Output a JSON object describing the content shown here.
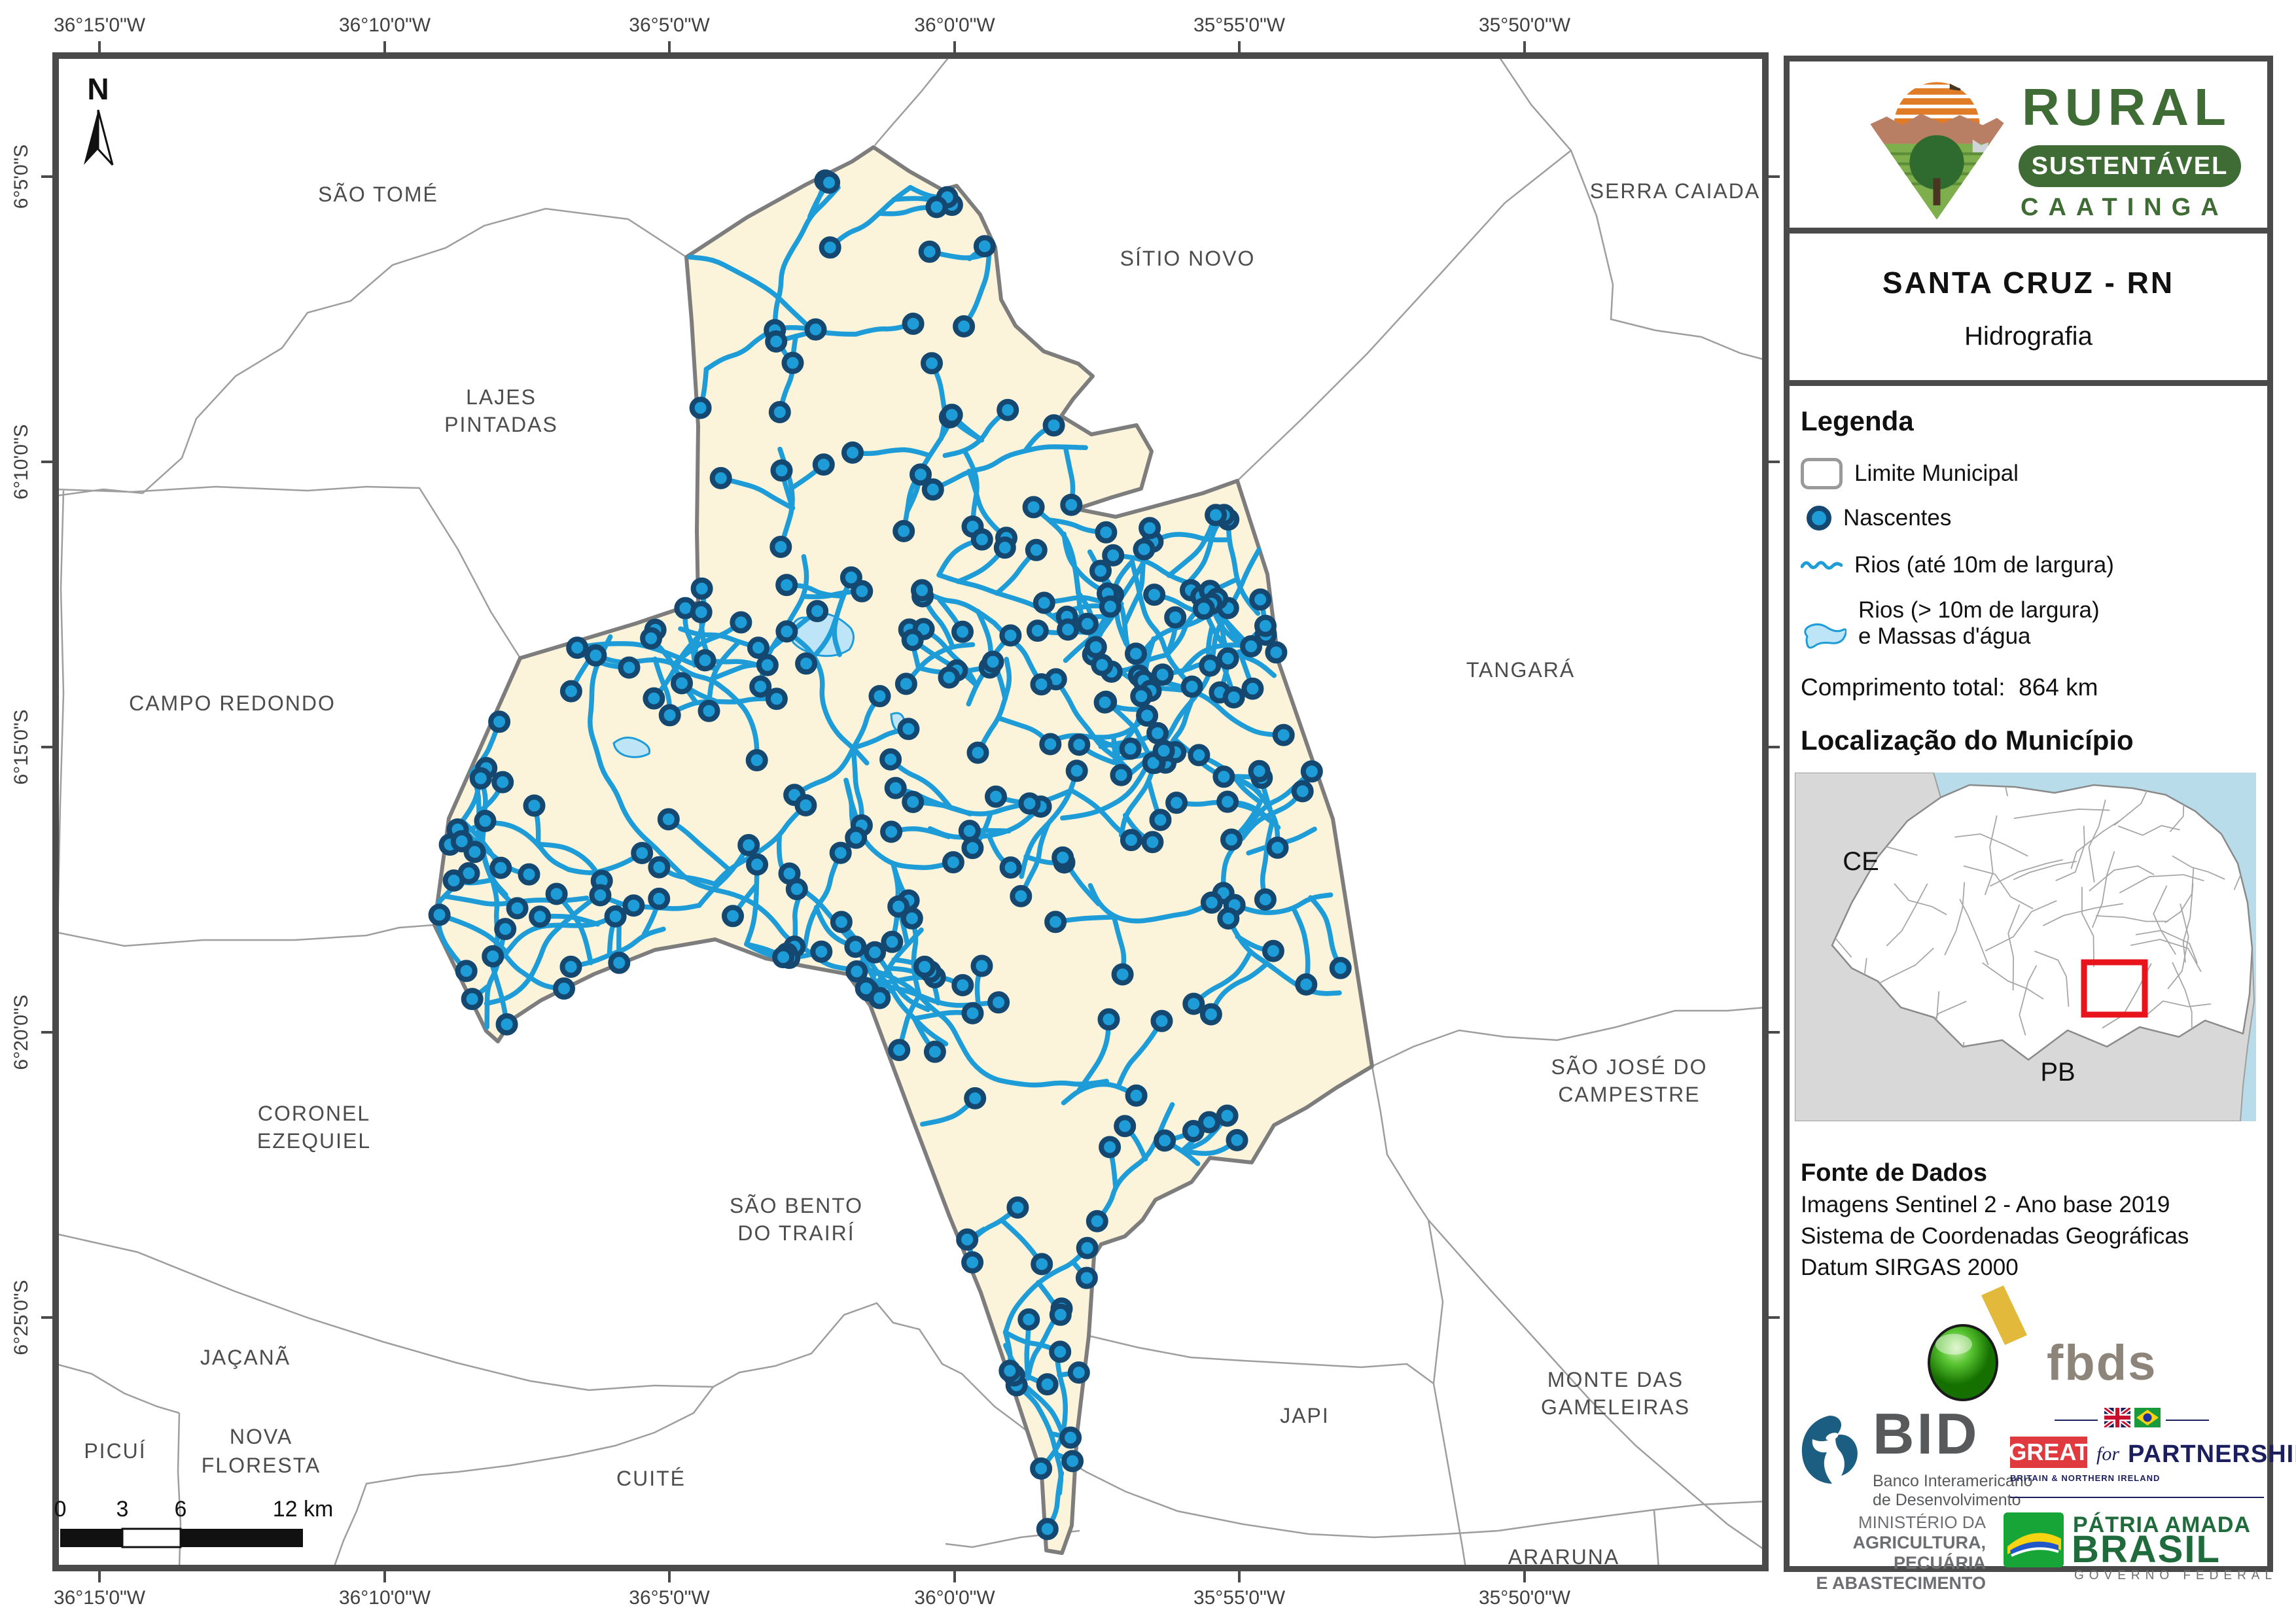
{
  "logo": {
    "line1": "RURAL",
    "line2": "SUSTENTÁVEL",
    "line3": "CAATINGA"
  },
  "title_block": {
    "municipality": "SANTA CRUZ - RN",
    "map_title": "Hidrografia"
  },
  "legend": {
    "header": "Legenda",
    "items": [
      {
        "key": "limite-municipal",
        "label": "Limite Municipal"
      },
      {
        "key": "nascentes",
        "label": "Nascentes"
      },
      {
        "key": "rios-ate-10m",
        "label": "Rios (até 10m de largura)"
      },
      {
        "key": "rios-maior-10m",
        "label": "Rios (> 10m de largura)",
        "label2": "e Massas d'água"
      }
    ],
    "total_label": "Comprimento total:",
    "total_value": "864 km"
  },
  "location": {
    "header": "Localização do Município",
    "ce": "CE",
    "pb": "PB"
  },
  "source": {
    "header": "Fonte de Dados",
    "lines": [
      "Imagens Sentinel 2 - Ano base 2019",
      "Sistema de Coordenadas Geográficas",
      "Datum SIRGAS 2000"
    ]
  },
  "partners": {
    "fbds": "fbds",
    "bid_acronym": "BID",
    "bid_name1": "Banco Interamericano",
    "bid_name2": "de Desenvolvimento",
    "great": "GREAT",
    "great_for": "for",
    "great_partnership": "PARTNERSHIP",
    "great_sub": "BRITAIN & NORTHERN IRELAND",
    "ministry": [
      "MINISTÉRIO DA",
      "AGRICULTURA, PECUÁRIA",
      "E ABASTECIMENTO"
    ],
    "patria1": "PÁTRIA AMADA",
    "patria2": "BRASIL",
    "patria3": "GOVERNO FEDERAL"
  },
  "map": {
    "north_label": "N",
    "longitudes": [
      "36°15'0\"W",
      "36°10'0\"W",
      "36°5'0\"W",
      "36°0'0\"W",
      "35°55'0\"W",
      "35°50'0\"W"
    ],
    "latitudes": [
      "6°5'0\"S",
      "6°10'0\"S",
      "6°15'0\"S",
      "6°20'0\"S",
      "6°25'0\"S"
    ],
    "neighbors": [
      "SÃO TOMÉ",
      "SÍTIO NOVO",
      "SERRA CAIADA",
      "LAJES\nPINTADAS",
      "TANGARÁ",
      "CAMPO REDONDO",
      "SÃO JOSÉ DO\nCAMPESTRE",
      "CORONEL\nEZEQUIEL",
      "SÃO BENTO\nDO TRAIRÍ",
      "JAÇANÃ",
      "JAPI",
      "MONTE DAS\nGAMELEIRAS",
      "PICUÍ",
      "NOVA\nFLORESTA",
      "CUITÉ",
      "ARARUNA"
    ],
    "scalebar": {
      "t0": "0",
      "t3": "3",
      "t6": "6",
      "t12": "12 km"
    }
  },
  "colors": {
    "municipality_fill": "#fbf4db",
    "river_blue": "#1e9cd8",
    "spring_ring": "#154870",
    "water_mass": "#bde5f7",
    "frame_gray": "#4a4a4a",
    "boundary_thin": "#9e9e9e",
    "municipality_outline": "#7d7d7d",
    "label_gray": "#4c4c4c",
    "logo_green": "#3f6b35",
    "sun_orange": "#e07b27",
    "red_locator": "#e8131b",
    "ocean_blue": "#b9dcea",
    "state_gray": "#d8d8d8"
  }
}
